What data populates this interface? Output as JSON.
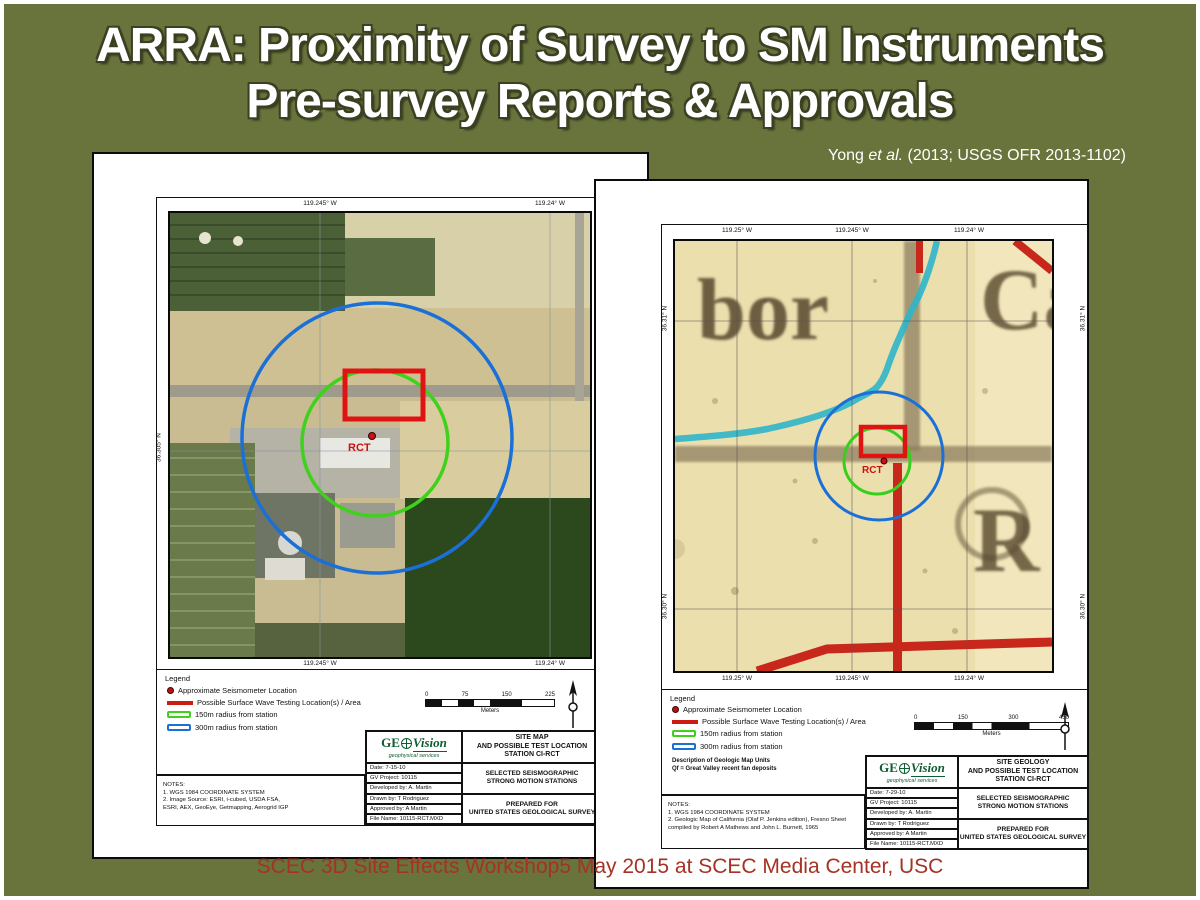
{
  "slide": {
    "title_line1": "ARRA: Proximity of Survey to SM Instruments",
    "title_line2": "Pre-survey Reports & Approvals",
    "citation_pre": "Yong ",
    "citation_italic": "et al.",
    "citation_post": " (2013; USGS OFR 2013-1102)",
    "footer": "SCEC 3D Site Effects Workshop5 May 2015 at SCEC Media Center, USC",
    "colors": {
      "background": "#68743c",
      "footer_text": "#a53222",
      "radius_150m": "#3fd11c",
      "radius_300m": "#1a70d6",
      "marker_red": "#cc1d14",
      "geology_paper": "#ecdfae"
    }
  },
  "left_page": {
    "coords": {
      "lon_left": "119.245° W",
      "lon_right": "119.24° W",
      "lat_left": "36.305° N",
      "lat_right": "36.305° N"
    },
    "map": {
      "station": "RCT"
    },
    "legend": {
      "title": "Legend",
      "items": [
        "Approximate Seismometer Location",
        "Possible Surface Wave Testing Location(s) / Area",
        "150m radius from station",
        "300m radius from station"
      ]
    },
    "scalebar": {
      "t0": "0",
      "t1": "75",
      "t2": "150",
      "t3": "225",
      "unit": "Meters"
    },
    "notes": {
      "l0": "NOTES:",
      "l1": "1.  WGS 1984 COORDINATE SYSTEM",
      "l2": "2.  Image Source: ESRI, i-cubed, USDA FSA,",
      "l3": "ESRI, AEX, GeoEye, Getmapping, Aerogrid IGP"
    },
    "titleblock": {
      "logo_ge": "GE",
      "logo_vision": "Vision",
      "logo_sub": "geophysical services",
      "title_l1": "SITE MAP",
      "title_l2": "AND POSSIBLE TEST LOCATION",
      "title_l3": "STATION CI-RCT",
      "rows": [
        "Date: 7-15-10",
        "GV Project: 10115",
        "Developed by: A. Martin",
        "Drawn by: T Rodriguez",
        "Approved by: A Martin",
        "File Name: 10115-RCT.MXD"
      ],
      "cell1_l1": "SELECTED SEISMOGRAPHIC",
      "cell1_l2": "STRONG MOTION STATIONS",
      "cell2_l1": "PREPARED FOR",
      "cell2_l2": "UNITED STATES GEOLOGICAL SURVEY"
    }
  },
  "right_page": {
    "coords": {
      "lon_1": "119.25° W",
      "lon_2": "119.245° W",
      "lon_3": "119.24° W",
      "lat_top": "36.31° N",
      "lat_bottom": "36.30° N"
    },
    "map": {
      "station": "RCT",
      "letters_1": "bor",
      "letters_2": "Ca",
      "letters_3": "R"
    },
    "legend": {
      "title": "Legend",
      "items": [
        "Approximate Seismometer Location",
        "Possible Surface Wave Testing Location(s) / Area",
        "150m radius from station",
        "300m radius from station"
      ],
      "desc_l1": "Description of Geologic Map Units",
      "desc_l2": "Qf = Great Valley recent fan deposits"
    },
    "scalebar": {
      "t0": "0",
      "t1": "150",
      "t2": "300",
      "t3": "450",
      "unit": "Meters"
    },
    "notes": {
      "l0": "NOTES:",
      "l1": "1.  WGS 1984 COORDINATE SYSTEM",
      "l2": "2.  Geologic Map of California (Olaf P. Jenkins edition), Fresno Sheet",
      "l3": "compiled by Robert A Mathews and John L. Burnett, 1965"
    },
    "titleblock": {
      "logo_ge": "GE",
      "logo_vision": "Vision",
      "logo_sub": "geophysical services",
      "title_l1": "SITE GEOLOGY",
      "title_l2": "AND POSSIBLE TEST LOCATION",
      "title_l3": "STATION CI-RCT",
      "rows": [
        "Date: 7-29-10",
        "GV Project: 10115",
        "Developed by: A. Martin",
        "Drawn by: T Rodriguez",
        "Approved by: A Martin",
        "File Name: 10115-RCT.MXD"
      ],
      "cell1_l1": "SELECTED SEISMOGRAPHIC",
      "cell1_l2": "STRONG MOTION STATIONS",
      "cell2_l1": "PREPARED FOR",
      "cell2_l2": "UNITED STATES GEOLOGICAL SURVEY"
    }
  }
}
